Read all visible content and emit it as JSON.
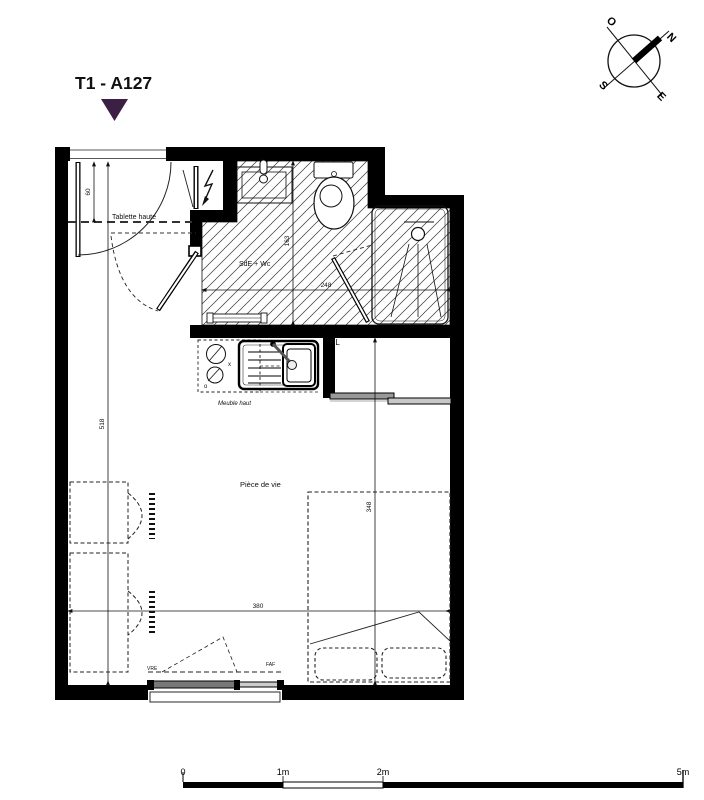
{
  "title": {
    "label": "T1 - A127"
  },
  "colors": {
    "accent": "#3c2044",
    "wall": "#000000"
  },
  "compass": {
    "north": "N",
    "south": "S",
    "east": "E",
    "west": "O"
  },
  "room_labels": {
    "bathroom": "SdE + Wc",
    "living_room": "Pièce de vie",
    "closet": "PL"
  },
  "annotations": {
    "high_shelf": "Tablette haute",
    "upper_cabinet": "Meuble haut",
    "window_left": "VRE",
    "window_right": "FAF",
    "hob_mark_x": "x",
    "hob_mark_o": "o"
  },
  "dimensions": {
    "entry_depth": "60",
    "bathroom_depth": "163",
    "bathroom_width": "248",
    "apartment_depth": "518",
    "bed_zone_depth": "348",
    "living_width": "380"
  },
  "scale_bar": {
    "zero": "0",
    "one": "1m",
    "two": "2m",
    "five": "5m"
  }
}
